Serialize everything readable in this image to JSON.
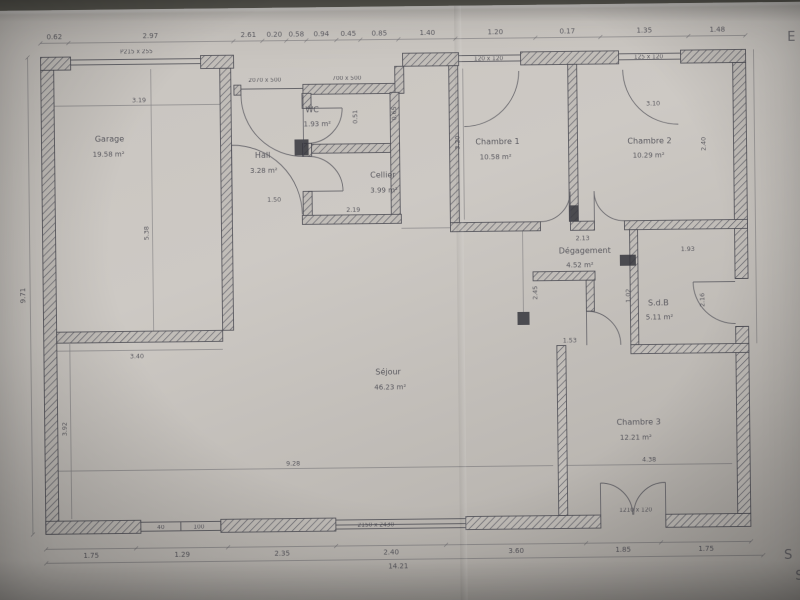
{
  "margin": {
    "letter_e": "E",
    "letter_s1": "S",
    "letter_s2": "S"
  },
  "rooms": [
    {
      "id": "garage",
      "name": "Garage",
      "area": "19.58 m²"
    },
    {
      "id": "hall",
      "name": "Hall",
      "area": "3.28 m²"
    },
    {
      "id": "wc",
      "name": "WC",
      "area": "1.93 m²"
    },
    {
      "id": "cellier",
      "name": "Cellier",
      "area": "3.99 m²"
    },
    {
      "id": "chambre1",
      "name": "Chambre 1",
      "area": "10.58 m²"
    },
    {
      "id": "chambre2",
      "name": "Chambre 2",
      "area": "10.29 m²"
    },
    {
      "id": "degagement",
      "name": "Dégagement",
      "area": "4.52 m²"
    },
    {
      "id": "sdb",
      "name": "S.d.B",
      "area": "5.11 m²"
    },
    {
      "id": "chambre3",
      "name": "Chambre 3",
      "area": "12.21 m²"
    },
    {
      "id": "sejour",
      "name": "Séjour",
      "area": "46.23 m²"
    }
  ],
  "openings": {
    "garage_door": "P215 x 255",
    "porch_window_1": "2070 x 500",
    "porch_window_2": "700 x 500",
    "chambre1_window": "120 x 120",
    "chambre2_window": "125 x 120",
    "bay_window": "2150 x 2430",
    "small_window_1": "40",
    "small_window_2": "100",
    "chambre3_window": "1210 x 120"
  },
  "dims": {
    "top": [
      "0.62",
      "2.97",
      "2.61",
      "0.20",
      "0.58",
      "0.94",
      "0.45",
      "0.85",
      "1.40",
      "1.20",
      "0.17",
      "1.35",
      "1.48"
    ],
    "bottom": [
      "1.75",
      "1.29",
      "2.35",
      "2.40",
      "3.60",
      "1.85",
      "1.75"
    ],
    "total_width": "14.21",
    "left_height": "9.71",
    "interior": [
      "3.19",
      "5.38",
      "3.40",
      "9.28",
      "4.38",
      "3.92",
      "3.20",
      "2.13",
      "1.50",
      "2.19",
      "0.51",
      "0.65",
      "3.10",
      "2.40",
      "2.45",
      "1.02",
      "1.93",
      "2.16",
      "1.53"
    ]
  }
}
